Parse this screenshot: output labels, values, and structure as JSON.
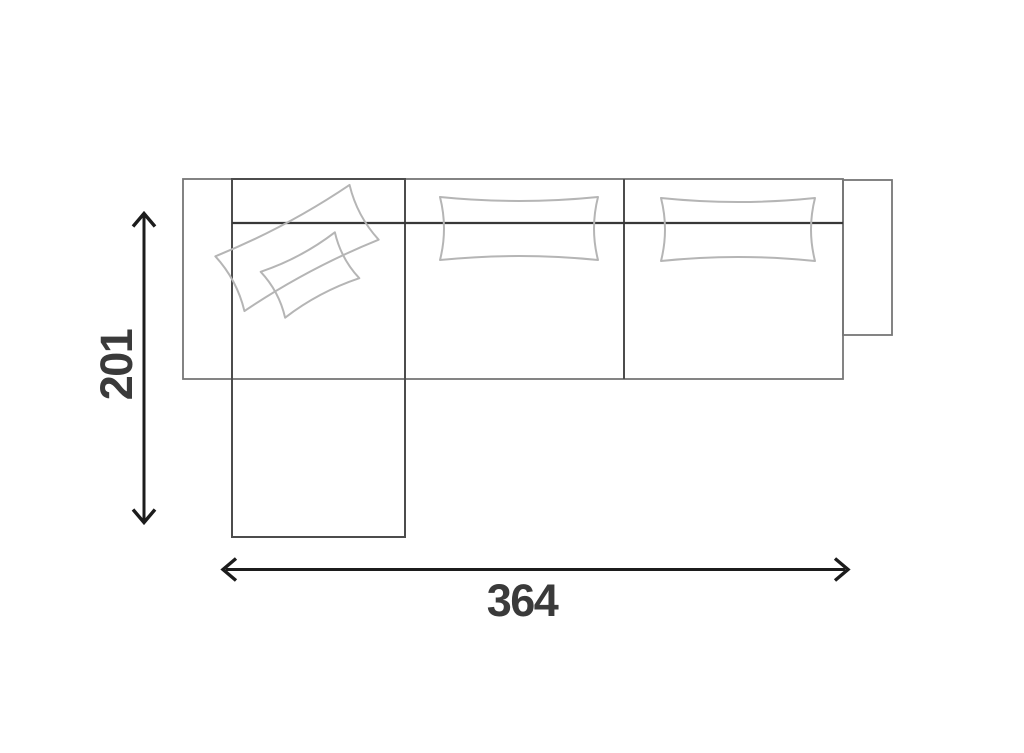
{
  "diagram": {
    "kind": "sofa-floor-plan-top-view",
    "dimensions": {
      "height_label": "201",
      "width_label": "364"
    }
  },
  "colors": {
    "background": "#ffffff",
    "frame": "#767676",
    "inner": "#4c4c4c",
    "backrest": "#383838",
    "pillow": "#b5b5b5",
    "dimension": "#1c1c1c",
    "label": "#3a3a3a"
  }
}
